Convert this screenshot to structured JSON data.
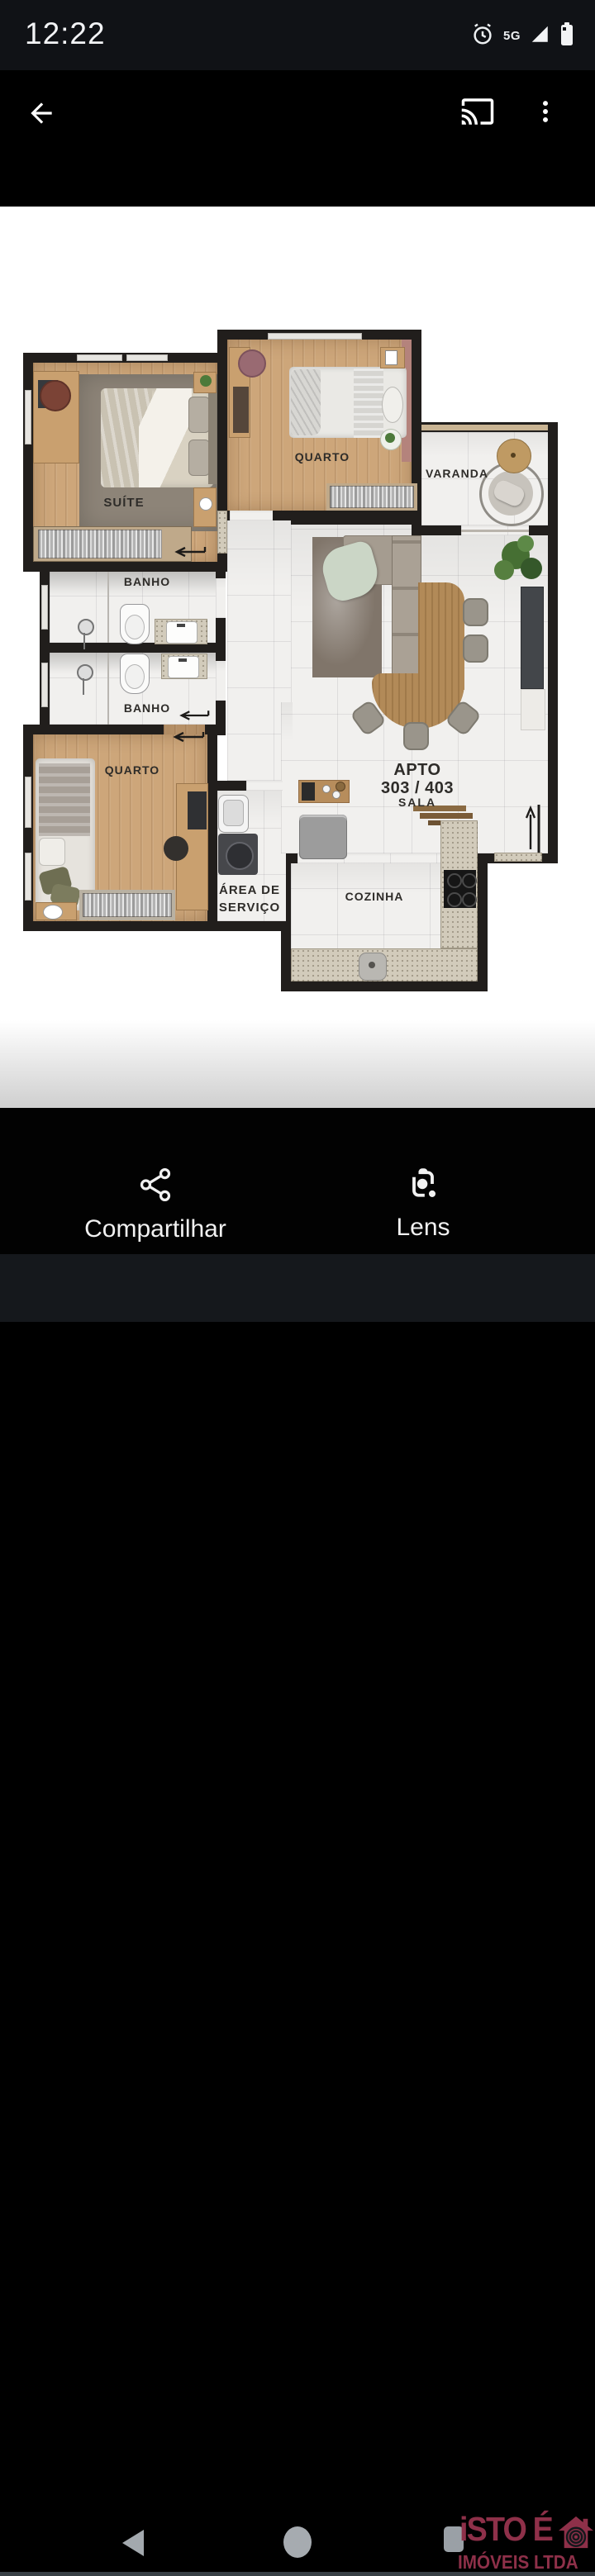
{
  "status_bar": {
    "time": "12:22",
    "network": "5G"
  },
  "plan": {
    "rooms": {
      "suite": "SUÍTE",
      "quarto_top": "QUARTO",
      "varanda": "VARANDA",
      "banho1": "BANHO",
      "banho2": "BANHO",
      "quarto_bottom": "QUARTO",
      "area_servico_line1": "ÁREA DE",
      "area_servico_line2": "SERVIÇO",
      "cozinha": "COZINHA"
    },
    "unit": {
      "line1": "APTO",
      "line2": "303 / 403",
      "line3": "SALA"
    }
  },
  "actions": {
    "share": "Compartilhar",
    "lens": "Lens"
  },
  "watermark": {
    "brand": "iSTO É",
    "subtitle": "IMÓVEIS LTDA"
  },
  "colors": {
    "watermark": "#8e3049",
    "wall": "#211e1c",
    "wood_floor": "#cda67a",
    "marble_floor": "#f1f0ee",
    "granite": "#d2cbbb",
    "accent_wall_pink": "#b4837c"
  }
}
